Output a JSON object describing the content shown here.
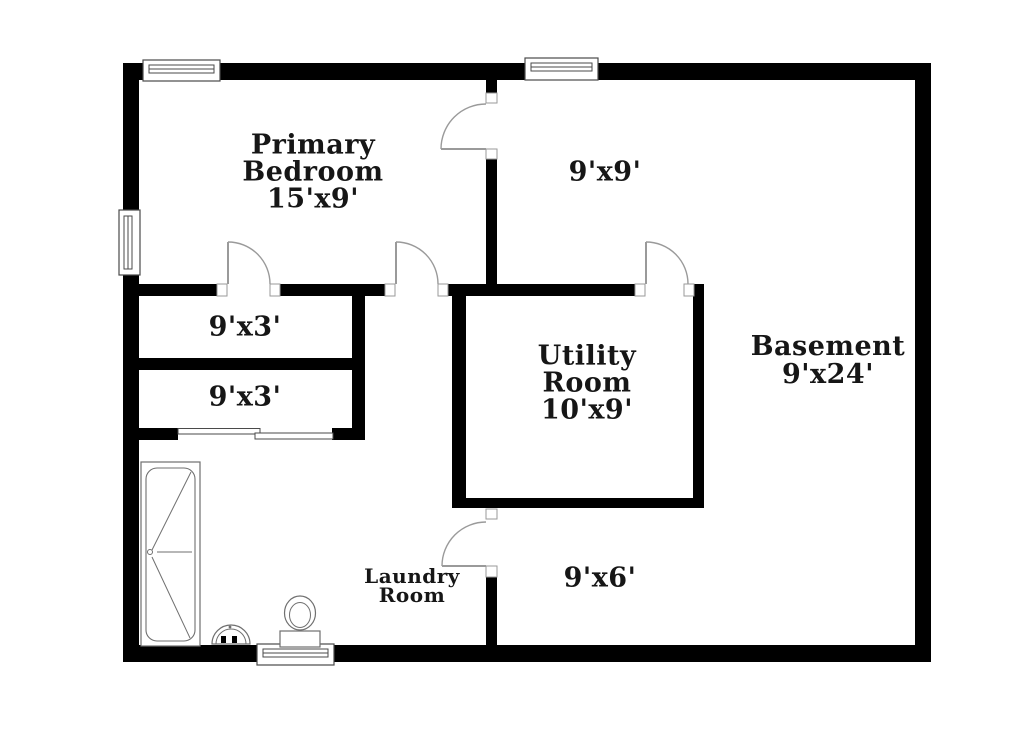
{
  "colors": {
    "wall": "#000000",
    "background": "#ffffff",
    "text": "#161616",
    "door_line": "#9a9a9a",
    "fixture_line": "#6f6f6f",
    "window_line": "#4a4a4a"
  },
  "labels": {
    "primary_bedroom": {
      "line1": "Primary",
      "line2": "Bedroom",
      "line3": "15'x9'"
    },
    "room_9x9": {
      "line1": "9'x9'"
    },
    "closet_top": {
      "line1": "9'x3'"
    },
    "closet_bottom": {
      "line1": "9'x3'"
    },
    "utility": {
      "line1": "Utility",
      "line2": "Room",
      "line3": "10'x9'"
    },
    "basement": {
      "line1": "Basement",
      "line2": "9'x24'"
    },
    "laundry": {
      "line1": "Laundry",
      "line2": "Room"
    },
    "area_9x6": {
      "line1": "9'x6'"
    }
  },
  "floorplan": {
    "walls": [
      {
        "x": 123,
        "y": 63,
        "w": 808,
        "h": 17
      },
      {
        "x": 123,
        "y": 645,
        "w": 808,
        "h": 17
      },
      {
        "x": 123,
        "y": 63,
        "w": 16,
        "h": 599
      },
      {
        "x": 915,
        "y": 63,
        "w": 16,
        "h": 599
      },
      {
        "x": 486,
        "y": 80,
        "w": 11,
        "h": 14
      },
      {
        "x": 486,
        "y": 159,
        "w": 11,
        "h": 126
      },
      {
        "x": 139,
        "y": 284,
        "w": 78,
        "h": 12
      },
      {
        "x": 280,
        "y": 284,
        "w": 105,
        "h": 12
      },
      {
        "x": 448,
        "y": 284,
        "w": 187,
        "h": 12
      },
      {
        "x": 452,
        "y": 296,
        "w": 14,
        "h": 212
      },
      {
        "x": 693,
        "y": 284,
        "w": 11,
        "h": 224
      },
      {
        "x": 452,
        "y": 498,
        "w": 252,
        "h": 10
      },
      {
        "x": 486,
        "y": 577,
        "w": 11,
        "h": 68
      },
      {
        "x": 139,
        "y": 358,
        "w": 226,
        "h": 12
      },
      {
        "x": 139,
        "y": 428,
        "w": 39,
        "h": 12
      },
      {
        "x": 332,
        "y": 428,
        "w": 33,
        "h": 12
      },
      {
        "x": 352,
        "y": 284,
        "w": 13,
        "h": 156
      }
    ],
    "jambs": [
      {
        "x": 217,
        "y": 284,
        "w": 10,
        "h": 12
      },
      {
        "x": 270,
        "y": 284,
        "w": 10,
        "h": 12
      },
      {
        "x": 385,
        "y": 284,
        "w": 10,
        "h": 12
      },
      {
        "x": 438,
        "y": 284,
        "w": 10,
        "h": 12
      },
      {
        "x": 635,
        "y": 284,
        "w": 10,
        "h": 12
      },
      {
        "x": 684,
        "y": 284,
        "w": 10,
        "h": 12
      },
      {
        "x": 486,
        "y": 93,
        "w": 11,
        "h": 10
      },
      {
        "x": 486,
        "y": 149,
        "w": 11,
        "h": 10
      },
      {
        "x": 486,
        "y": 509,
        "w": 11,
        "h": 10
      },
      {
        "x": 486,
        "y": 566,
        "w": 11,
        "h": 11
      }
    ],
    "doors": [
      {
        "leaf": [
          228,
          284,
          228,
          242
        ],
        "arc": {
          "x1": 228,
          "y1": 242,
          "r": 42,
          "x2": 270,
          "y2": 284
        }
      },
      {
        "leaf": [
          396,
          284,
          396,
          242
        ],
        "arc": {
          "x1": 396,
          "y1": 242,
          "r": 42,
          "x2": 438,
          "y2": 284
        }
      },
      {
        "leaf": [
          646,
          284,
          646,
          242
        ],
        "arc": {
          "x1": 646,
          "y1": 242,
          "r": 42,
          "x2": 688,
          "y2": 284
        }
      },
      {
        "leaf": [
          486,
          149,
          441,
          149
        ],
        "arc": {
          "x1": 441,
          "y1": 149,
          "r": 45,
          "x2": 486,
          "y2": 104
        }
      },
      {
        "leaf": [
          486,
          566,
          442,
          566
        ],
        "arc": {
          "x1": 442,
          "y1": 566,
          "r": 44,
          "x2": 486,
          "y2": 522
        }
      }
    ],
    "windows": [
      {
        "x": 143,
        "y": 60,
        "w": 77,
        "h": 21,
        "orient": "h"
      },
      {
        "x": 525,
        "y": 58,
        "w": 73,
        "h": 22,
        "orient": "h"
      },
      {
        "x": 119,
        "y": 210,
        "w": 21,
        "h": 65,
        "orient": "v"
      },
      {
        "x": 257,
        "y": 644,
        "w": 77,
        "h": 21,
        "orient": "h"
      }
    ],
    "sliding_panels": [
      {
        "x": 178,
        "y": 428.5,
        "w": 82,
        "h": 5.5
      },
      {
        "x": 255,
        "y": 433,
        "w": 78,
        "h": 6
      }
    ],
    "bathtub": {
      "outer": [
        141,
        462,
        59,
        184
      ],
      "inner": [
        146,
        468,
        49,
        173
      ],
      "lines": [
        [
          191,
          472,
          152,
          550
        ],
        [
          157,
          552,
          192,
          552
        ],
        [
          152,
          557,
          190,
          638
        ]
      ],
      "drain": [
        150,
        552,
        2.5
      ]
    },
    "sink": {
      "cx": 231,
      "base_y": 644,
      "r_outer": 19,
      "r_inner": 15,
      "faucets": [
        [
          221,
          636,
          5,
          7
        ],
        [
          232,
          636,
          5,
          7
        ]
      ],
      "dot": [
        230,
        627,
        1.4
      ]
    },
    "toilet": {
      "bowl": [
        300,
        613,
        15.5,
        17
      ],
      "bowl_inner": [
        300,
        615,
        10.5,
        12.5
      ],
      "tank": [
        280,
        631,
        40,
        16
      ]
    }
  }
}
